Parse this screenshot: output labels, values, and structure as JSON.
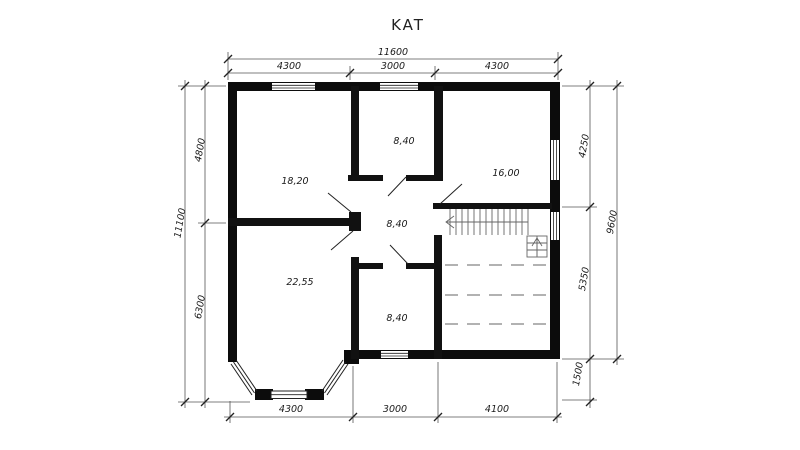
{
  "title": "KAT",
  "colors": {
    "wall": "#0c0c0c",
    "dimension_line": "#555555",
    "tick": "#222222",
    "text": "#1a1a1a",
    "stair_line": "#666666",
    "dashed_line": "#999999",
    "background": "#ffffff"
  },
  "rooms": [
    {
      "id": "room-18-20",
      "area": "18,20"
    },
    {
      "id": "room-8-40-top",
      "area": "8,40"
    },
    {
      "id": "room-16-00",
      "area": "16,00"
    },
    {
      "id": "hall-8-40",
      "area": "8,40"
    },
    {
      "id": "room-22-55",
      "area": "22,55"
    },
    {
      "id": "room-8-40-bottom",
      "area": "8,40"
    }
  ],
  "dims": {
    "top_total": "11600",
    "top": [
      "4300",
      "3000",
      "4300"
    ],
    "left_total": "11100",
    "left": [
      "4800",
      "6300"
    ],
    "right_total": "9600",
    "right": [
      "4250",
      "5350",
      "1500"
    ],
    "bottom": [
      "4300",
      "3000",
      "4100"
    ]
  }
}
